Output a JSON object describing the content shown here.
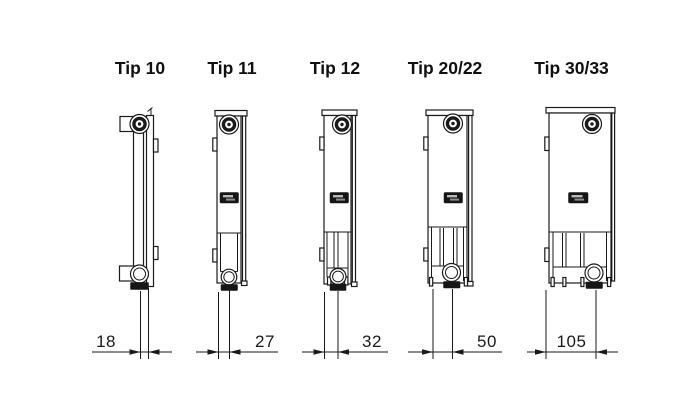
{
  "diagram": {
    "description": "Radiator type depth cross-sections",
    "unit": "mm"
  },
  "colors": {
    "background": "#ffffff",
    "line": "#1a1a1a",
    "badge": "#161616"
  },
  "types": [
    {
      "id": "tip-10",
      "label": "Tip 10",
      "depth_mm": "18"
    },
    {
      "id": "tip-11",
      "label": "Tip 11",
      "depth_mm": "27"
    },
    {
      "id": "tip-12",
      "label": "Tip 12",
      "depth_mm": "32"
    },
    {
      "id": "tip-20-22",
      "label": "Tip 20/22",
      "depth_mm": "50"
    },
    {
      "id": "tip-30-33",
      "label": "Tip 30/33",
      "depth_mm": "105"
    }
  ]
}
